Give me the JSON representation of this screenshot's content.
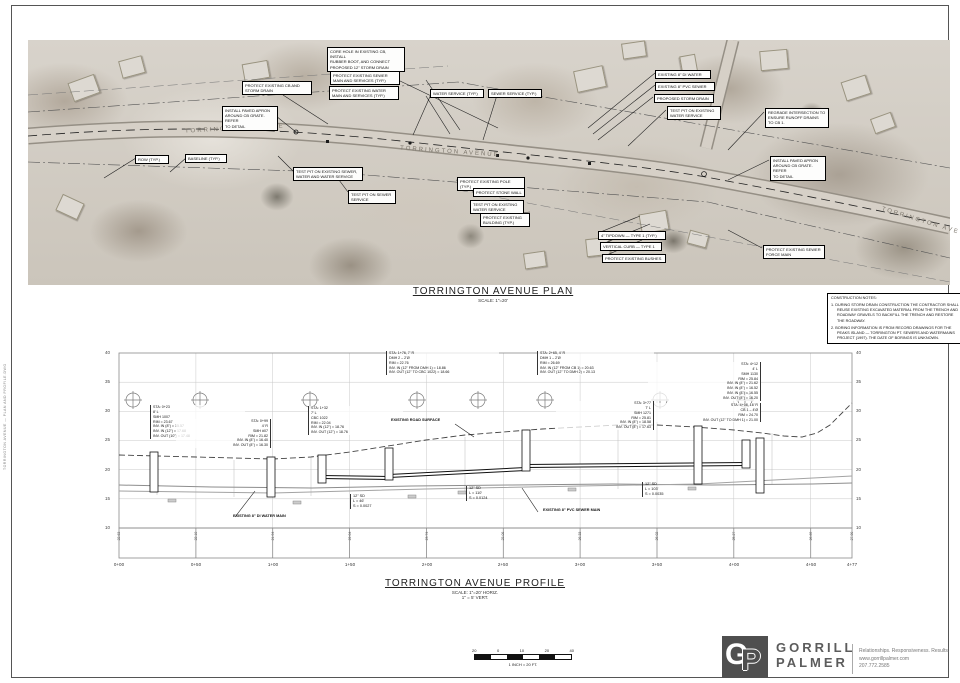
{
  "sheet": {
    "edge_text": "TORRINGTON AVENUE — PLAN AND PROFILE.DWG"
  },
  "plan": {
    "title": "TORRINGTON AVENUE PLAN",
    "scale": "SCALE: 1\"=20'",
    "street_labels": [
      "TORRINGTON AVENUE",
      "TORRINGTON AVENUE",
      "TORRINGTON AVE"
    ],
    "labels": [
      {
        "text": "CORE HOLE IN EXISTING CB, INSTALL\nRUBBER BOOT, AND CONNECT\nPROPOSED 12\" STORM DRAIN"
      },
      {
        "text": "PROTECT EXISTING CB AND\nSTORM DRAIN"
      },
      {
        "text": "PROTECT EXISTING SEWER\nMAIN AND SERVICES (TYP.)"
      },
      {
        "text": "PROTECT EXISTING WATER\nMAIN AND SERVICES (TYP.)"
      },
      {
        "text": "WATER SERVICE (TYP.)"
      },
      {
        "text": "SEWER SERVICE (TYP.)"
      },
      {
        "text": "EXISTING 8\" DI WATER"
      },
      {
        "text": "EXISTING 8\" PVC SEWER"
      },
      {
        "text": "PROPOSED STORM DRAIN"
      },
      {
        "text": "TEST PIT ON EXISTING\nWATER SERVICE"
      },
      {
        "text": "REGRADE INTERSECTION TO\nENSURE RUNOFF DRAINS\nTO CB 1."
      },
      {
        "text": "INSTALL PAVED APRON\nAROUND CB GRATE. REFER\nTO DETAIL"
      },
      {
        "text": "ROW (TYP.)"
      },
      {
        "text": "BASELINE (TYP.)"
      },
      {
        "text": "TEST PIT ON EXISTING SEWER,\nWATER AND WATER SERVICE"
      },
      {
        "text": "TEST PIT ON SEWER\nSERVICE"
      },
      {
        "text": "PROTECT EXISTING POLE (TYP.)"
      },
      {
        "text": "PROTECT STONE WALL"
      },
      {
        "text": "TEST PIT ON EXISTING\nWATER SERVICE"
      },
      {
        "text": "PROTECT EXISTING\nBUILDING (TYP.)"
      },
      {
        "text": "4\" TIPDOWN — TYPE 1 (TYP.)"
      },
      {
        "text": "VERTICAL CURB — TYPE 1"
      },
      {
        "text": "PROTECT EXISTING BUSHES"
      },
      {
        "text": "PROTECT EXISTING SEWER\nFORCE MAIN"
      },
      {
        "text": "INSTALL PAVED APRON\nAROUND CB GRATE. REFER\nTO DETAIL"
      }
    ]
  },
  "construction_notes": {
    "title": "CONSTRUCTION NOTES:",
    "items": [
      "1. DURING STORM DRAIN CONSTRUCTION THE CONTRACTOR SHALL REUSE EXISTING EXCAVATED MATERIAL FROM THE TRENCH AND ROADWAY GRAVELS TO BACKFILL THE TRENCH AND RESTORE THE ROADWAY.",
      "2. BORING INFORMATION IS FROM RECORD DRAWINGS FOR THE PEAKS ISLAND — TORRINGTON PT. SEWERS AND WATERMAINS PROJECT (1997). THE DATE OF BORINGS IS UNKNOWN."
    ]
  },
  "profile": {
    "title": "TORRINGTON AVENUE PROFILE",
    "scale_lines": "SCALE: 1\"=20' HORIZ.\n1\" = 5' VERT.",
    "elevation_ticks": [
      "40",
      "35",
      "30",
      "25",
      "20",
      "15",
      "10"
    ],
    "stations": [
      "0+00",
      "0+50",
      "1+00",
      "1+50",
      "2+00",
      "2+50",
      "3+00",
      "3+50",
      "4+00",
      "4+50",
      "4+77"
    ],
    "datum_elevations": [
      "22.63",
      "22.10",
      "21.94",
      "22.04",
      "23.74",
      "25.06",
      "26.33",
      "26.02",
      "25.27",
      "26.69",
      "27.90"
    ],
    "callouts": [
      {
        "text": "STA: 1+76, 7' R\nDMH 2 – 2'Ø\nRIM = 22.76\nINV. IN (12\" FROM DMH 1) = 18.86\nINV. OUT (12\" TO CBC 1022) = 18.66"
      },
      {
        "text": "STA: 2+65, 4' R\nDMH 1 – 2'Ø\nRIM = 26.69\nINV. IN (12\" FROM CB 1) = 20.63\nINV. OUT (12\" TO DMH 2) = 20.13"
      },
      {
        "text": "STA: 4+12\n4' L\nSMH 1130\nRIM = 25.84\nINV. IN (8\") = 21.62\nINV. IN (8\") = 16.52\nINV. IN (8\") = 16.55\nINV. OUT (8\") = 16.20"
      },
      {
        "text": "STA: 4+08, 16' R\nCB 1 – 4'Ø\nRIM = 24.70\nINV. OUT (12\" TO DMH 1) = 21.00"
      },
      {
        "text": "STA: 0+23\n8' L\nSMH 1007\nRIM = 23.67\nINV. IN (8\") = 15.57\nINV. IN (12\") = 17.68\nINV. OUT (10\") = 17.48"
      },
      {
        "text": "STA: 0+99\n4' R\nSMH #07\nRIM = 21.82\nINV. IN (8\") = 16.40\nINV. OUT (8\") = 16.30"
      },
      {
        "text": "STA: 1+32\n7' L\nCBC 1022\nRIM = 22.04\nINV. IN (12\") = 18.76\nINV. OUT (12\") = 18.76"
      },
      {
        "text": "STA: 3+77\n7' L\nSMH 1271\nRIM = 25.81\nINV. IN (8\") = 18.58\nINV. OUT (8\") = 17.63"
      }
    ],
    "labels": [
      {
        "text": "EXISTING ROAD SURFACE"
      },
      {
        "text": "EXISTING 8\" DI WATER MAIN"
      },
      {
        "text": "12\" SD\nL = 46'\nS = 0.0027"
      },
      {
        "text": "12\" SD\nL = 110'\nS = 0.0124"
      },
      {
        "text": "EXISTING 8\" PVC SEWER MAIN"
      },
      {
        "text": "12\" SD\nL = 103'\nS = 0.0035"
      }
    ]
  },
  "scale_bar": {
    "ticks": [
      "20",
      "0",
      "10",
      "20",
      "40"
    ],
    "caption": "1 INCH = 20 FT."
  },
  "logo": {
    "monogram_g": "G",
    "monogram_p": "P",
    "name_line1": "GORRILL",
    "name_line2": "PALMER",
    "tagline": "Relationships. Responsiveness. Results.",
    "website": "www.gorrillpalmer.com",
    "phone": "207.772.2585"
  }
}
